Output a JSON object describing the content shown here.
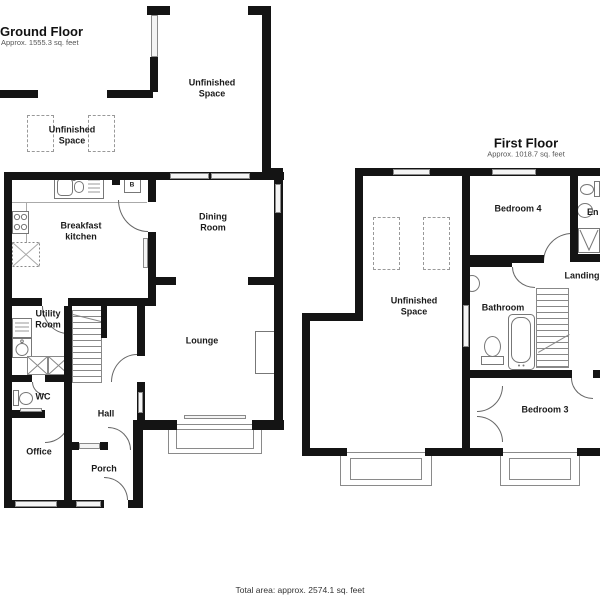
{
  "ground_floor": {
    "title": "Ground Floor",
    "area": "Approx. 1555.3 sq. feet",
    "boiler_label": "B",
    "rooms": {
      "unfinished_space_upper": "Unfinished Space",
      "unfinished_space_top": "Unfinished Space",
      "breakfast_kitchen": "Breakfast kitchen",
      "dining_room": "Dining Room",
      "lounge": "Lounge",
      "utility_room": "Utility Room",
      "wc": "WC",
      "hall": "Hall",
      "office": "Office",
      "porch": "Porch"
    }
  },
  "first_floor": {
    "title": "First Floor",
    "area": "Approx. 1018.7 sq. feet",
    "rooms": {
      "unfinished_space": "Unfinished Space",
      "bedroom_4": "Bedroom 4",
      "ensuite": "En",
      "landing": "Landing",
      "bathroom": "Bathroom",
      "bedroom_3": "Bedroom 3"
    }
  },
  "footer": {
    "total_area": "Total area: approx. 2574.1 sq. feet"
  },
  "colors": {
    "wall": "#141414",
    "door_arc": "#666666",
    "fixture_outline": "#777777",
    "label": "#1a1a1a"
  }
}
